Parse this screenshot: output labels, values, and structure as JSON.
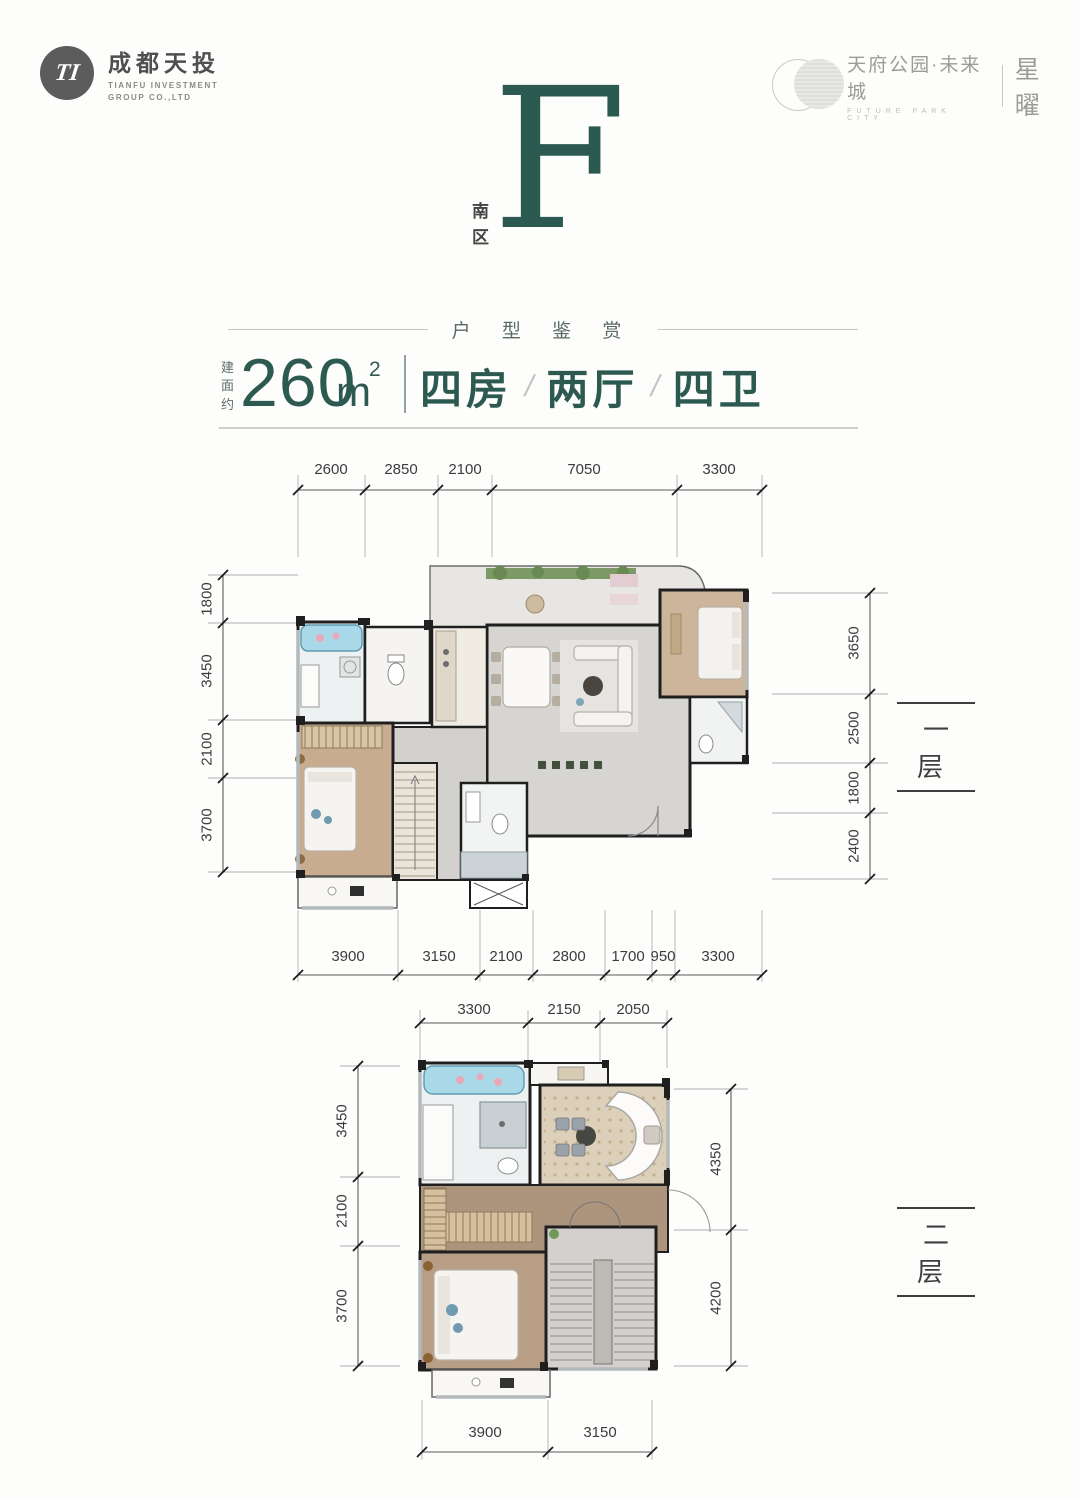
{
  "brand_left": {
    "name": "成都天投",
    "monogram": "TI",
    "line1": "TIANFU INVESTMENT",
    "line2": "GROUP CO.,LTD"
  },
  "brand_right": {
    "name": "天府公园·未来城",
    "sub": "FUTURE PARK CITY",
    "mark": "星曜"
  },
  "hero": {
    "letter": "F",
    "zone": "南区"
  },
  "section_title": "户 型 鉴 赏",
  "spec": {
    "prefix_chars": [
      "建",
      "面",
      "约"
    ],
    "area": "260",
    "unit": "m",
    "sup": "2",
    "rooms": "四房",
    "halls": "两厅",
    "baths": "四卫",
    "slash": "/"
  },
  "floor1": {
    "label": "一层",
    "dims_top": [
      "2600",
      "2850",
      "2100",
      "7050",
      "3300"
    ],
    "dims_bottom": [
      "3900",
      "3150",
      "2100",
      "2800",
      "1700",
      "950",
      "3300"
    ],
    "dims_left": [
      "1800",
      "3450",
      "2100",
      "3700"
    ],
    "dims_right": [
      "3650",
      "2500",
      "1800",
      "2400"
    ]
  },
  "floor2": {
    "label": "二层",
    "dims_top": [
      "3300",
      "2150",
      "2050"
    ],
    "dims_bottom": [
      "3900",
      "3150"
    ],
    "dims_left": [
      "3450",
      "2100",
      "3700"
    ],
    "dims_right": [
      "4350",
      "4200"
    ]
  },
  "colors": {
    "accent_teal": "#2d5a50",
    "dim_text": "#3c3c3c",
    "wall": "#1f1f1f",
    "marble": "#d7d5d2",
    "wood": "#c7ac8f",
    "water_blue": "#a9d9e8"
  }
}
